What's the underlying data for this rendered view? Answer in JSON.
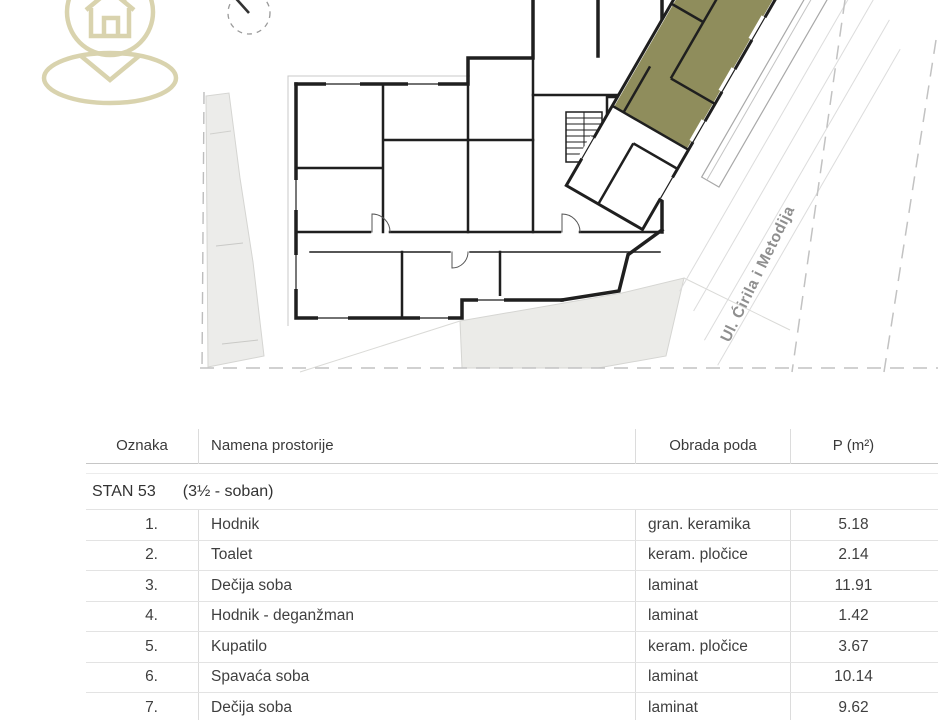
{
  "logo": {
    "icon": "house-location-pin-icon",
    "color": "#d9d3ae"
  },
  "plan": {
    "street_label": "Ul. Ćirila i Metodija",
    "compass": "north-needle-icon",
    "highlight_color": "#8f8d5c"
  },
  "table": {
    "headers": {
      "oznaka": "Oznaka",
      "namena": "Namena prostorije",
      "obrada": "Obrada poda",
      "p": "P (m²)"
    },
    "group": {
      "title": "STAN 53",
      "subtitle": "(3½ - soban)"
    },
    "rows": [
      {
        "num": "1.",
        "name": "Hodnik",
        "floor": "gran. keramika",
        "area": "5.18"
      },
      {
        "num": "2.",
        "name": "Toalet",
        "floor": "keram. pločice",
        "area": "2.14"
      },
      {
        "num": "3.",
        "name": "Dečija soba",
        "floor": "laminat",
        "area": "11.91"
      },
      {
        "num": "4.",
        "name": "Hodnik - deganžman",
        "floor": "laminat",
        "area": "1.42"
      },
      {
        "num": "5.",
        "name": "Kupatilo",
        "floor": "keram. pločice",
        "area": "3.67"
      },
      {
        "num": "6.",
        "name": "Spavaća soba",
        "floor": "laminat",
        "area": "10.14"
      },
      {
        "num": "7.",
        "name": "Dečija soba",
        "floor": "laminat",
        "area": "9.62"
      },
      {
        "num": "8.",
        "name": "Dnevni boravak sa trpezarijom i kuhinjom",
        "floor": "gran. keramika",
        "area": "34.78"
      }
    ]
  }
}
